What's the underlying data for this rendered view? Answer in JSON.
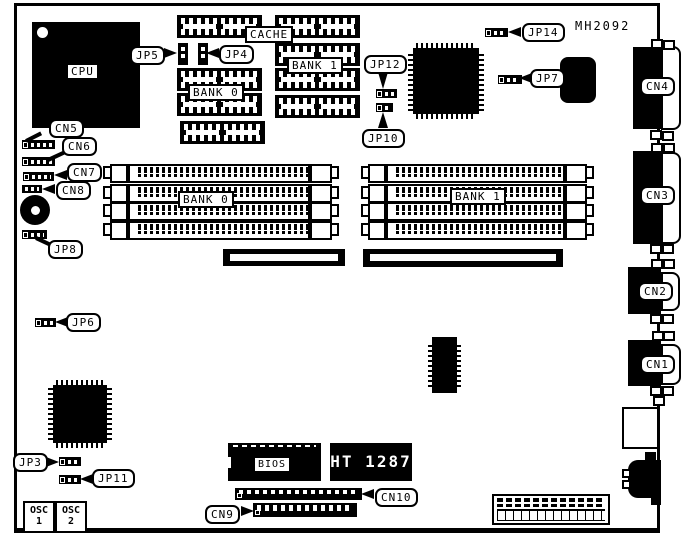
{
  "part_number": "MH2092",
  "components": {
    "cpu": "CPU",
    "cache": "CACHE",
    "cache_bank0": "BANK 0",
    "cache_bank1": "BANK 1",
    "simm_bank0": "BANK 0",
    "simm_bank1": "BANK 1",
    "bios": "BIOS",
    "ht_chip": "HT 1287"
  },
  "jumpers": {
    "jp3": "JP3",
    "jp4": "JP4",
    "jp5": "JP5",
    "jp6": "JP6",
    "jp7": "JP7",
    "jp8": "JP8",
    "jp10": "JP10",
    "jp11": "JP11",
    "jp12": "JP12",
    "jp14": "JP14"
  },
  "connectors": {
    "cn1": "CN1",
    "cn2": "CN2",
    "cn3": "CN3",
    "cn4": "CN4",
    "cn5": "CN5",
    "cn6": "CN6",
    "cn7": "CN7",
    "cn8": "CN8",
    "cn9": "CN9",
    "cn10": "CN10"
  },
  "oscillators": {
    "osc1_name": "OSC",
    "osc1_num": "1",
    "osc2_name": "OSC",
    "osc2_num": "2"
  },
  "colors": {
    "line": "#000000",
    "background": "#ffffff"
  }
}
